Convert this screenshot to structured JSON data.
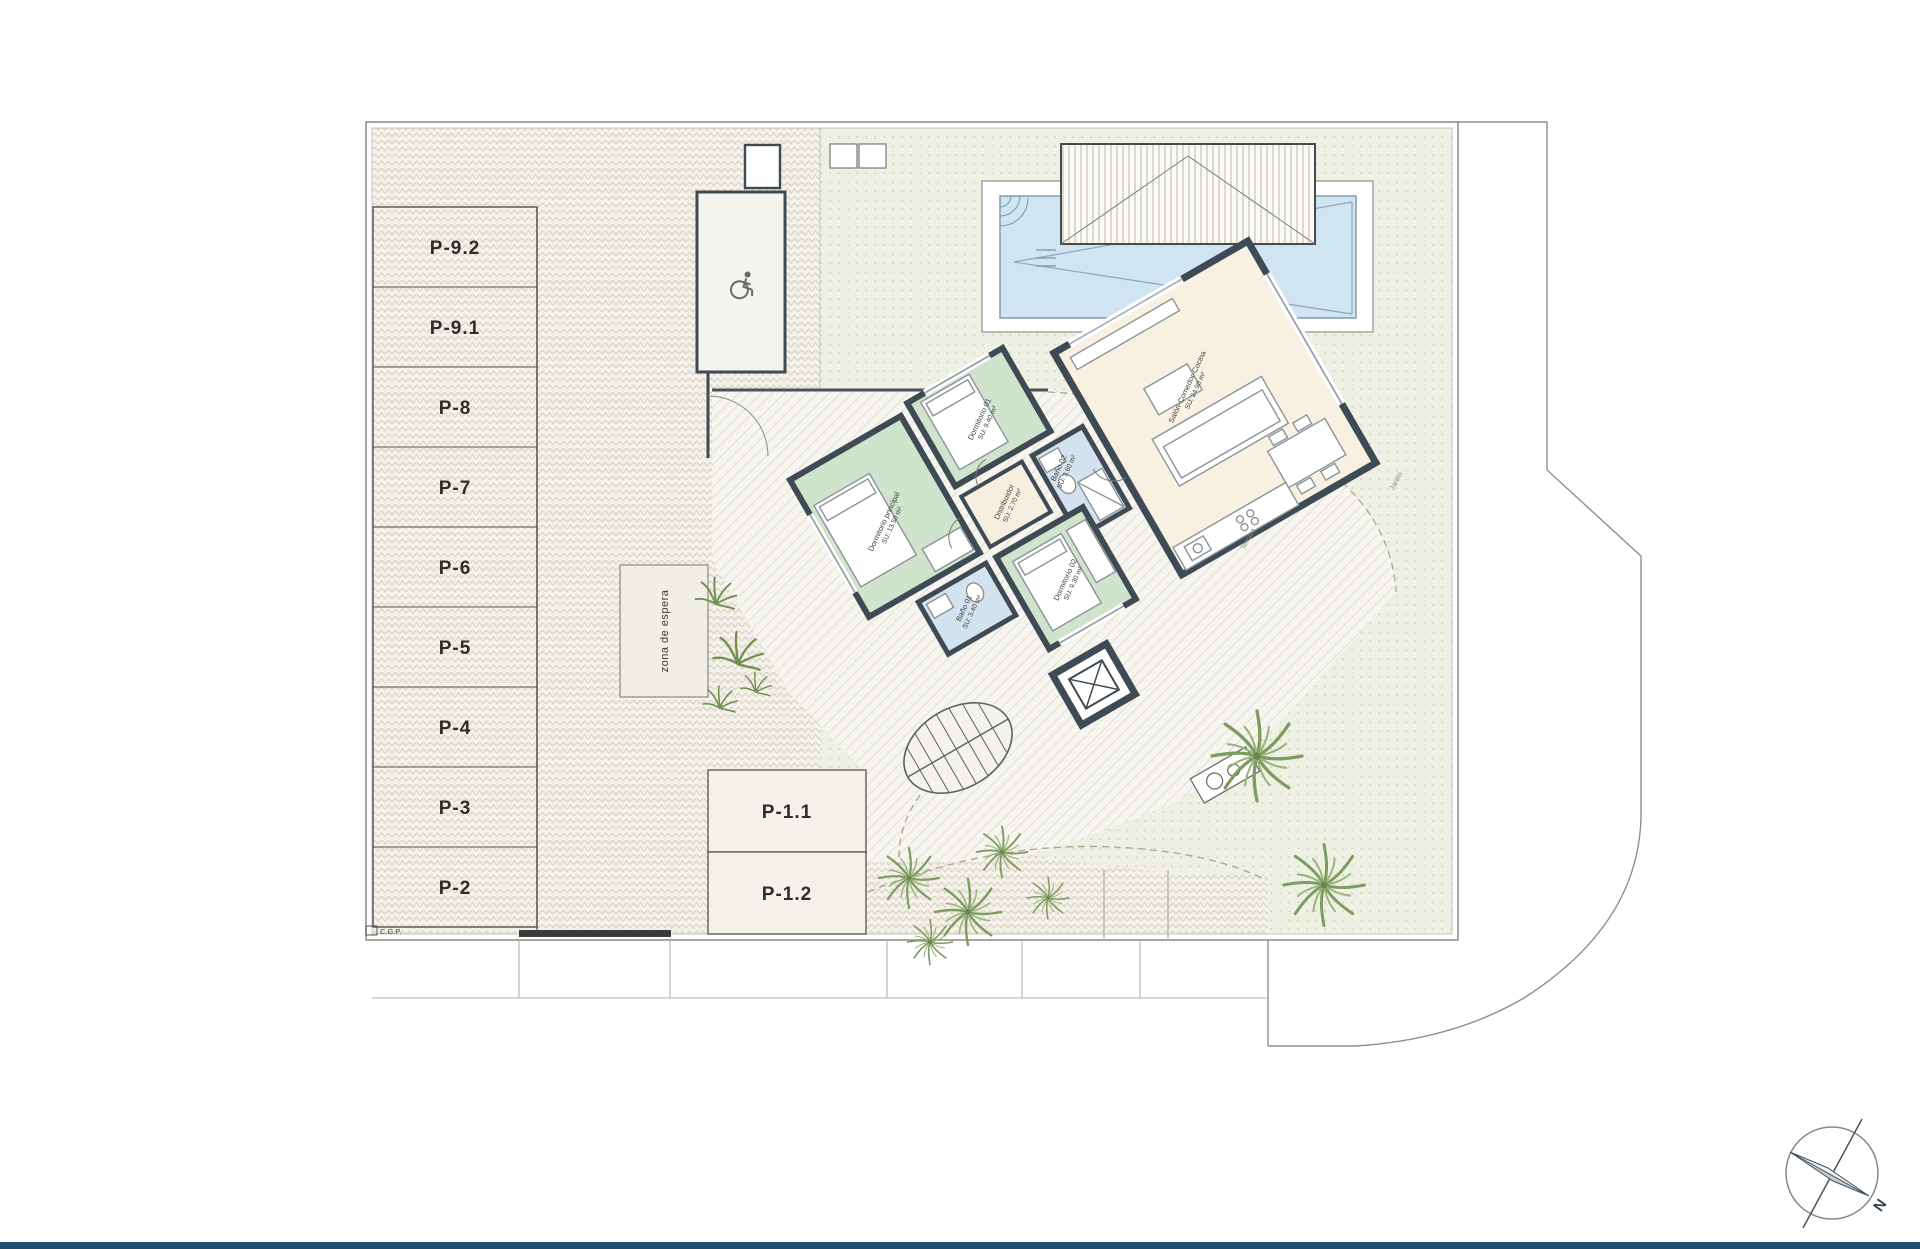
{
  "plan": {
    "parking_stalls": [
      "P-9.2",
      "P-9.1",
      "P-8",
      "P-7",
      "P-6",
      "P-5",
      "P-4",
      "P-3",
      "P-2"
    ],
    "entry_stalls": [
      "P-1.1",
      "P-1.2"
    ],
    "waiting_area_label": "zona de espera",
    "utility_label": "C.G.P.",
    "rooms": {
      "principal": {
        "name": "Dormitorio principal",
        "area": "SU: 13.50 m²"
      },
      "dorm01": {
        "name": "Dormitorio 01",
        "area": "SU: 9.40 m²"
      },
      "dorm02": {
        "name": "Dormitorio 02",
        "area": "SU: 9.30 m²"
      },
      "bano01": {
        "name": "Baño 01",
        "area": "SU: 3.40 m²"
      },
      "bano02": {
        "name": "Baño 02",
        "area": "SU: 3.60 m²"
      },
      "distribuidor": {
        "name": "Distribuidor",
        "area": "SU: 2.70 m²"
      },
      "salon": {
        "name": "Salón-Comedor-Cocina",
        "area": "SU: 24.90 m²"
      }
    },
    "outdoor": {
      "terrace": "Terraza",
      "garden": "Jardín"
    },
    "compass_north": "N"
  },
  "colors": {
    "footer_bar": "#1d4e6e",
    "bedroom": "#cfe3cd",
    "bathroom": "#d3e2ee",
    "living": "#f8f1e2",
    "hall": "#f6efe0",
    "pool_water": "#cfe5f2",
    "wall": "#3e4a54"
  }
}
